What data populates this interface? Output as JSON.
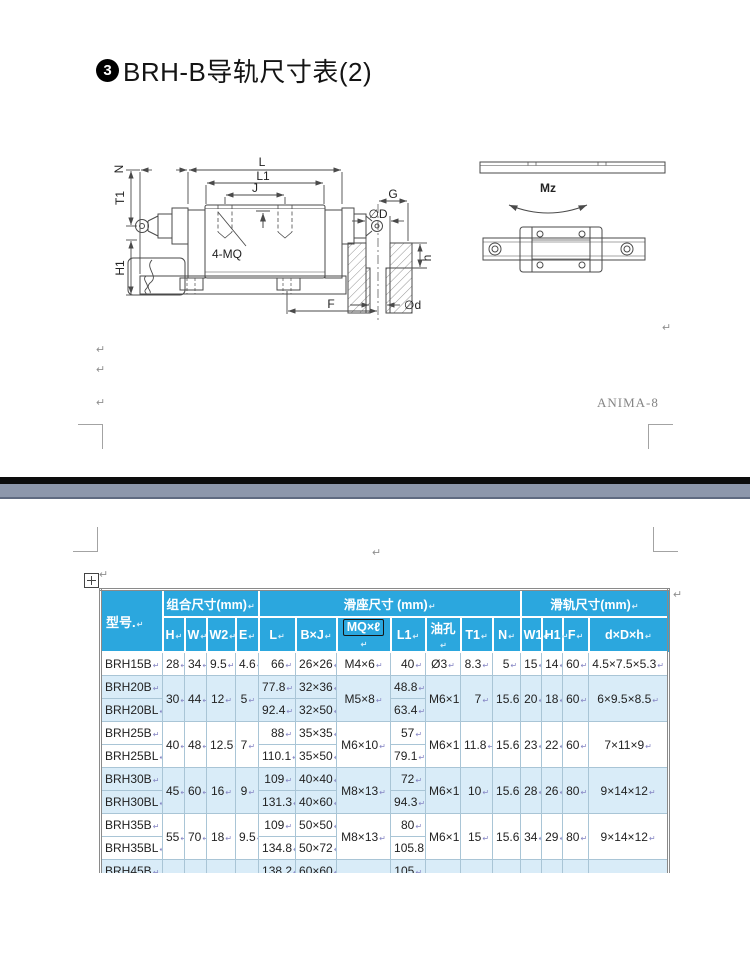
{
  "page": {
    "title_badge": "3",
    "title_text": "BRH-B导轨尺寸表(2)",
    "watermark": "ANIMA-8",
    "pilcrow": "↵"
  },
  "diagram": {
    "labels": {
      "N": "N",
      "T1": "T1",
      "H1": "H1",
      "L": "L",
      "L1": "L1",
      "J": "J",
      "G": "G",
      "D": "∅D",
      "h": "h",
      "d": "∅d",
      "F": "F",
      "MQ": "4-MQ",
      "Mz": "Mz"
    }
  },
  "table": {
    "corner_header": "型号.",
    "groups": [
      {
        "label": "组合尺寸(mm)",
        "span": 4
      },
      {
        "label": "滑座尺寸 (mm)",
        "span": 7
      },
      {
        "label": "滑轨尺寸(mm)",
        "span": 4
      }
    ],
    "columns": [
      "H",
      "W",
      "W2",
      "E",
      "L",
      "B×J",
      "MQ×ℓ",
      "L1",
      "油孔",
      "T1",
      "N",
      "W1",
      "H1",
      "F",
      "d×D×h"
    ],
    "boxed_column": "MQ×ℓ",
    "rows": [
      {
        "model": "BRH15B",
        "alt": false,
        "cells": [
          [
            "28",
            1
          ],
          [
            "34",
            1
          ],
          [
            "9.5",
            1
          ],
          [
            "4.6",
            1
          ],
          [
            "66",
            1
          ],
          [
            "26×26",
            1
          ],
          [
            "M4×6",
            1
          ],
          [
            "40",
            1
          ],
          [
            "Ø3",
            1
          ],
          [
            "8.3",
            1
          ],
          [
            "5",
            1
          ],
          [
            "15",
            1
          ],
          [
            "14",
            1
          ],
          [
            "60",
            1
          ],
          [
            "4.5×7.5×5.3",
            1
          ]
        ]
      },
      {
        "model": "BRH20B",
        "alt": true,
        "cells": [
          [
            "30",
            2
          ],
          [
            "44",
            2
          ],
          [
            "12",
            2
          ],
          [
            "5",
            2
          ],
          [
            "77.8",
            1
          ],
          [
            "32×36",
            1
          ],
          [
            "M5×8",
            2
          ],
          [
            "48.8",
            1
          ],
          [
            "M6×1",
            2
          ],
          [
            "7",
            2
          ],
          [
            "15.6",
            2
          ],
          [
            "20",
            2
          ],
          [
            "18",
            2
          ],
          [
            "60",
            2
          ],
          [
            "6×9.5×8.5",
            2
          ]
        ]
      },
      {
        "model": "BRH20BL",
        "alt": true,
        "cells": [
          null,
          null,
          null,
          null,
          [
            "92.4",
            1
          ],
          [
            "32×50",
            1
          ],
          null,
          [
            "63.4",
            1
          ],
          null,
          null,
          null,
          null,
          null,
          null,
          null
        ]
      },
      {
        "model": "BRH25B",
        "alt": false,
        "cells": [
          [
            "40",
            2
          ],
          [
            "48",
            2
          ],
          [
            "12.5",
            2
          ],
          [
            "7",
            2
          ],
          [
            "88",
            1
          ],
          [
            "35×35",
            1
          ],
          [
            "M6×10",
            2
          ],
          [
            "57",
            1
          ],
          [
            "M6×1",
            2
          ],
          [
            "11.8",
            2
          ],
          [
            "15.6",
            2
          ],
          [
            "23",
            2
          ],
          [
            "22",
            2
          ],
          [
            "60",
            2
          ],
          [
            "7×11×9",
            2
          ]
        ]
      },
      {
        "model": "BRH25BL",
        "alt": false,
        "cells": [
          null,
          null,
          null,
          null,
          [
            "110.1",
            1
          ],
          [
            "35×50",
            1
          ],
          null,
          [
            "79.1",
            1
          ],
          null,
          null,
          null,
          null,
          null,
          null,
          null
        ]
      },
      {
        "model": "BRH30B",
        "alt": true,
        "cells": [
          [
            "45",
            2
          ],
          [
            "60",
            2
          ],
          [
            "16",
            2
          ],
          [
            "9",
            2
          ],
          [
            "109",
            1
          ],
          [
            "40×40",
            1
          ],
          [
            "M8×13",
            2
          ],
          [
            "72",
            1
          ],
          [
            "M6×1",
            2
          ],
          [
            "10",
            2
          ],
          [
            "15.6",
            2
          ],
          [
            "28",
            2
          ],
          [
            "26",
            2
          ],
          [
            "80",
            2
          ],
          [
            "9×14×12",
            2
          ]
        ]
      },
      {
        "model": "BRH30BL",
        "alt": true,
        "cells": [
          null,
          null,
          null,
          null,
          [
            "131.3",
            1
          ],
          [
            "40×60",
            1
          ],
          null,
          [
            "94.3",
            1
          ],
          null,
          null,
          null,
          null,
          null,
          null,
          null
        ]
      },
      {
        "model": "BRH35B",
        "alt": false,
        "cells": [
          [
            "55",
            2
          ],
          [
            "70",
            2
          ],
          [
            "18",
            2
          ],
          [
            "9.5",
            2
          ],
          [
            "109",
            1
          ],
          [
            "50×50",
            1
          ],
          [
            "M8×13",
            2
          ],
          [
            "80",
            1
          ],
          [
            "M6×1",
            2
          ],
          [
            "15",
            2
          ],
          [
            "15.6",
            2
          ],
          [
            "34",
            2
          ],
          [
            "29",
            2
          ],
          [
            "80",
            2
          ],
          [
            "9×14×12",
            2
          ]
        ]
      },
      {
        "model": "BRH35BL",
        "alt": false,
        "cells": [
          null,
          null,
          null,
          null,
          [
            "134.8",
            1
          ],
          [
            "50×72",
            1
          ],
          null,
          [
            "105.8",
            1
          ],
          null,
          null,
          null,
          null,
          null,
          null,
          null
        ]
      },
      {
        "model": "BRH45B",
        "alt": true,
        "cells": [
          [
            "70",
            2
          ],
          [
            "86",
            2
          ],
          [
            "20.5",
            2
          ],
          [
            "14",
            2
          ],
          [
            "138.2",
            1
          ],
          [
            "60×60",
            1
          ],
          [
            "M10×16.5",
            2
          ],
          [
            "105",
            1
          ],
          [
            "M8×1",
            2
          ],
          [
            "18.5",
            2
          ],
          [
            "16",
            2
          ],
          [
            "45",
            2
          ],
          [
            "38",
            2
          ],
          [
            "105",
            2
          ],
          [
            "14×20×17",
            2
          ]
        ]
      },
      {
        "model": "BRH45BL",
        "alt": true,
        "cells": [
          null,
          null,
          null,
          null,
          [
            "163",
            1
          ],
          [
            "60×80",
            1
          ],
          null,
          [
            "129.8",
            1
          ],
          null,
          null,
          null,
          null,
          null,
          null,
          null
        ]
      }
    ]
  }
}
